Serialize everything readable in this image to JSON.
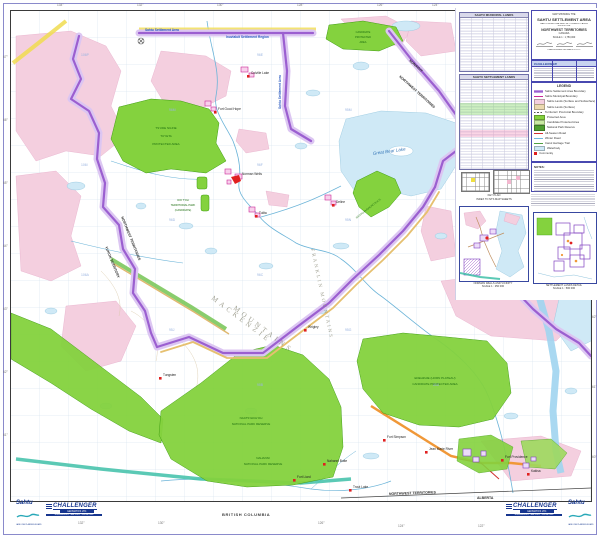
{
  "page_title": "Sahtu Settlement Area Map",
  "colors": {
    "boundary_purple": "#9b5fd0",
    "boundary_halo": "#dcc6f2",
    "protected_green": "#84d23e",
    "parcel_pink": "#f4cfdf",
    "water_blue": "#cfe9f6",
    "community_red": "#e02020",
    "winter_road_teal": "#3ec0a8",
    "road_orange": "#f09838",
    "label_blue": "#2858c0"
  },
  "margins": {
    "top_ticks": [
      "134°",
      "132°",
      "130°",
      "128°",
      "126°",
      "124°",
      "122°"
    ],
    "left_ticks": [
      "67°",
      "66°",
      "65°",
      "64°",
      "63°",
      "62°",
      "61°"
    ],
    "right_ticks": [
      "62°",
      "61°",
      "60°"
    ],
    "bottom_ticks": [
      "132°",
      "130°",
      "128°",
      "126°",
      "124°",
      "122°",
      "120°"
    ],
    "bc_label": "BRITISH COLUMBIA",
    "alberta_label": "ALBERTA",
    "nwt_label": "NORTHWEST TERRITORIES"
  },
  "panel": {
    "table1_title": "SAHTU MUNICIPAL LANDS",
    "table2_title": "SAHTU SETTLEMENT LANDS",
    "title_block": {
      "kicker": "MAP SHOWING THE",
      "title": "SAHTU SETTLEMENT AREA",
      "sub1": "SAHTU MUNICIPAL AND SETTLEMENT LANDS",
      "sub2": "WITHIN THE",
      "region": "NORTHWEST TERRITORIES",
      "country": "CANADA",
      "scale": "SCALE 1 : 1,750,000",
      "credit": "CHALLENGER GEOMATICS LTD."
    },
    "legend": {
      "title": "LEGEND",
      "items": [
        {
          "label": "Sahtu Settlement Area Boundary",
          "sw": "purple-band"
        },
        {
          "label": "Sahtu Municipal Boundary",
          "sw": "magenta-line"
        },
        {
          "label": "Sahtu Lands (Surface and Subsurface)",
          "sw": "pink-fill"
        },
        {
          "label": "Sahtu Lands (Surface)",
          "sw": "tan-fill"
        },
        {
          "label": "Territorial / Provincial Boundary",
          "sw": "gray-dash"
        },
        {
          "label": "Protected Area",
          "sw": "green-fill"
        },
        {
          "label": "Candidate Protected Area",
          "sw": "pale-green-fill"
        },
        {
          "label": "National Park Reserve",
          "sw": "dark-green-fill"
        },
        {
          "label": "All-Season Road",
          "sw": "red-line"
        },
        {
          "label": "Winter Road",
          "sw": "blue-line"
        },
        {
          "label": "Canol Heritage Trail",
          "sw": "green-line"
        },
        {
          "label": "Waterbody",
          "sw": "water-fill"
        },
        {
          "label": "Community",
          "sw": "red-square"
        }
      ]
    },
    "notes_title": "NOTES:",
    "key_plan_caption1": "KEY PLAN",
    "key_plan_caption2": "INDEX TO NTS MAP SHEETS",
    "inset1_caption1": "NORMAN WELLS AND VICINITY",
    "inset1_caption2": "SCALE 1 : 250 000",
    "inset2_caption1": "SETTLEMENT LANDS DETAIL",
    "inset2_caption2": "SCALE 1 : 500 000"
  },
  "map": {
    "labels": {
      "inuvialuit": "Inuvialuit Settlement Region",
      "sahtu": "Sahtu Settlement Area",
      "sahtu_vertical": "Sahtu Settlement Area",
      "nunavut": "NUNAVUT",
      "nwt_diag": "NORTHWEST TERRITORIES",
      "nwt_yukon": "NORTHWEST TERRITORIES",
      "yukon": "YUKON TERRITORY",
      "mack1": "MACKENZIE",
      "mack2": "MOUNTAINS",
      "franklin": "FRANKLIN MOUNTAINS",
      "great_bear": "Great Bear Lake",
      "nwt_bottom": "NORTHWEST TERRITORIES",
      "alberta_bottom": "ALBERTA"
    },
    "protected_areas": {
      "tuyeta1": "TS'UDE NILINE",
      "tuyeta2": "TUYETA",
      "tuyeta3": "PROTECTED AREA",
      "maunoir1": "CANDIDATE",
      "maunoir2": "PROTECTED",
      "maunoir3": "AREA",
      "saoyu": "SAOYU-EHDACHO N.H.S.",
      "doitoh1": "DOI T'OH",
      "doitoh2": "TERRITORIAL PARK",
      "doitoh3": "(CANDIDATE)",
      "naats1": "NAATS'IHCH'OH",
      "naats2": "NATIONAL PARK RESERVE",
      "nahanni1": "NAHANNI",
      "nahanni2": "NATIONAL PARK RESERVE",
      "edehzhie1": "EDEHZHIE (HORN PLATEAU)",
      "edehzhie2": "CANDIDATE PROTECTED AREA"
    },
    "communities": [
      {
        "name": "Colville Lake"
      },
      {
        "name": "Fort Good Hope"
      },
      {
        "name": "Norman Wells"
      },
      {
        "name": "Tulita"
      },
      {
        "name": "Deline"
      },
      {
        "name": "Wrigley"
      },
      {
        "name": "Tungsten"
      },
      {
        "name": "Fort Simpson"
      },
      {
        "name": "Nahanni Butte"
      },
      {
        "name": "Fort Liard"
      },
      {
        "name": "Trout Lake"
      },
      {
        "name": "Jean Marie River"
      },
      {
        "name": "Fort Providence"
      },
      {
        "name": "Kakisa"
      }
    ],
    "nts_labels": [
      "106P",
      "106I",
      "106A",
      "96M",
      "96D",
      "96E",
      "96F",
      "96C",
      "95M",
      "95N",
      "95J",
      "95B",
      "95G",
      "85D"
    ]
  },
  "logos": {
    "sahtu_text": "Sahtu",
    "sahtu_sub": "LAND USE PLANNING BOARD",
    "challenger_text": "CHALLENGER",
    "challenger_sub": "GEOMATICS LTD.",
    "challenger_bar": "ENGINEERING · MAPPING · SURVEYING"
  }
}
